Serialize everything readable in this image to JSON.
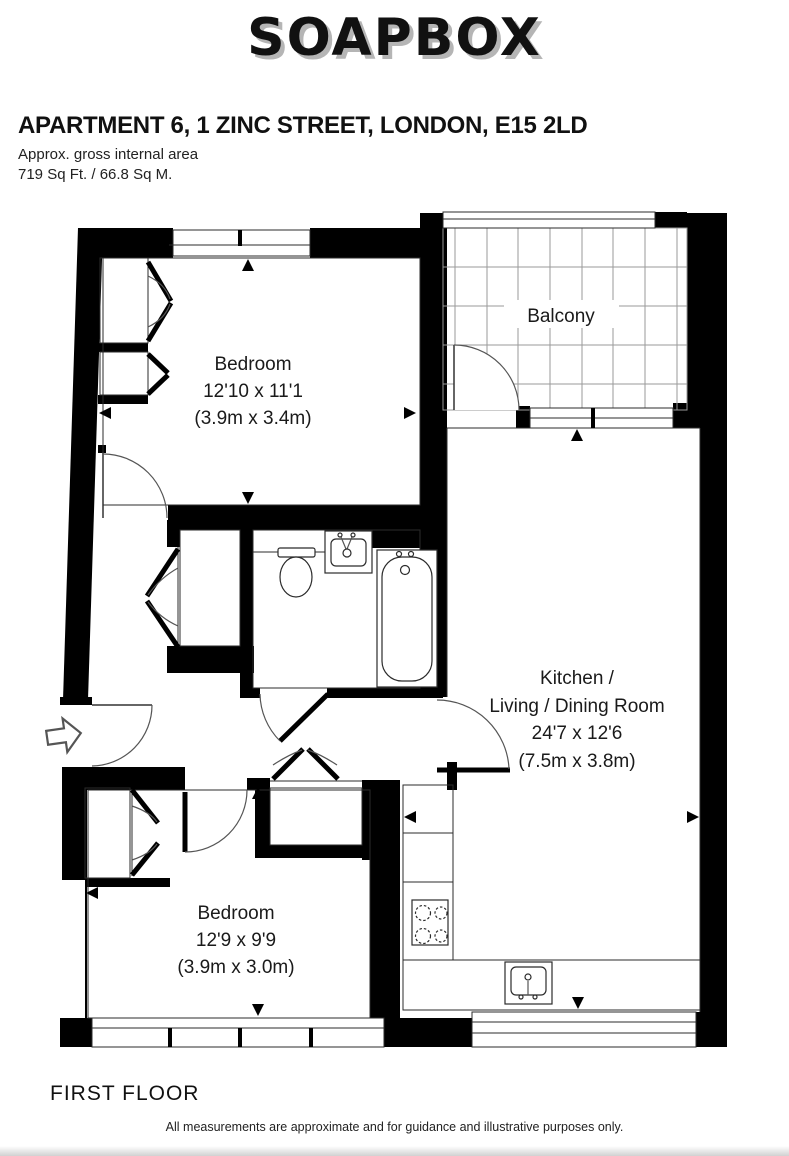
{
  "logo": {
    "text": "SOAPBOX"
  },
  "header": {
    "title": "APARTMENT 6, 1 ZINC STREET, LONDON, E15 2LD",
    "subtitle": "Approx. gross internal area",
    "area": "719 Sq Ft. / 66.8 Sq M."
  },
  "rooms": {
    "bedroom1": {
      "name": "Bedroom",
      "imperial": "12'10 x 11'1",
      "metric": "(3.9m x 3.4m)"
    },
    "balcony": {
      "name": "Balcony"
    },
    "kitchen": {
      "name_line1": "Kitchen /",
      "name_line2": "Living / Dining Room",
      "imperial": "24'7 x 12'6",
      "metric": "(7.5m x 3.8m)"
    },
    "bedroom2": {
      "name": "Bedroom",
      "imperial": "12'9 x 9'9",
      "metric": "(3.9m x 3.0m)"
    }
  },
  "footer": {
    "floor_label": "FIRST FLOOR",
    "disclaimer": "All measurements are approximate and for guidance and illustrative purposes only."
  },
  "colors": {
    "wall": "#000000",
    "grid": "#9a9a9a",
    "logo_shadow": "#b5b5b5",
    "text": "#1a1a1a"
  }
}
